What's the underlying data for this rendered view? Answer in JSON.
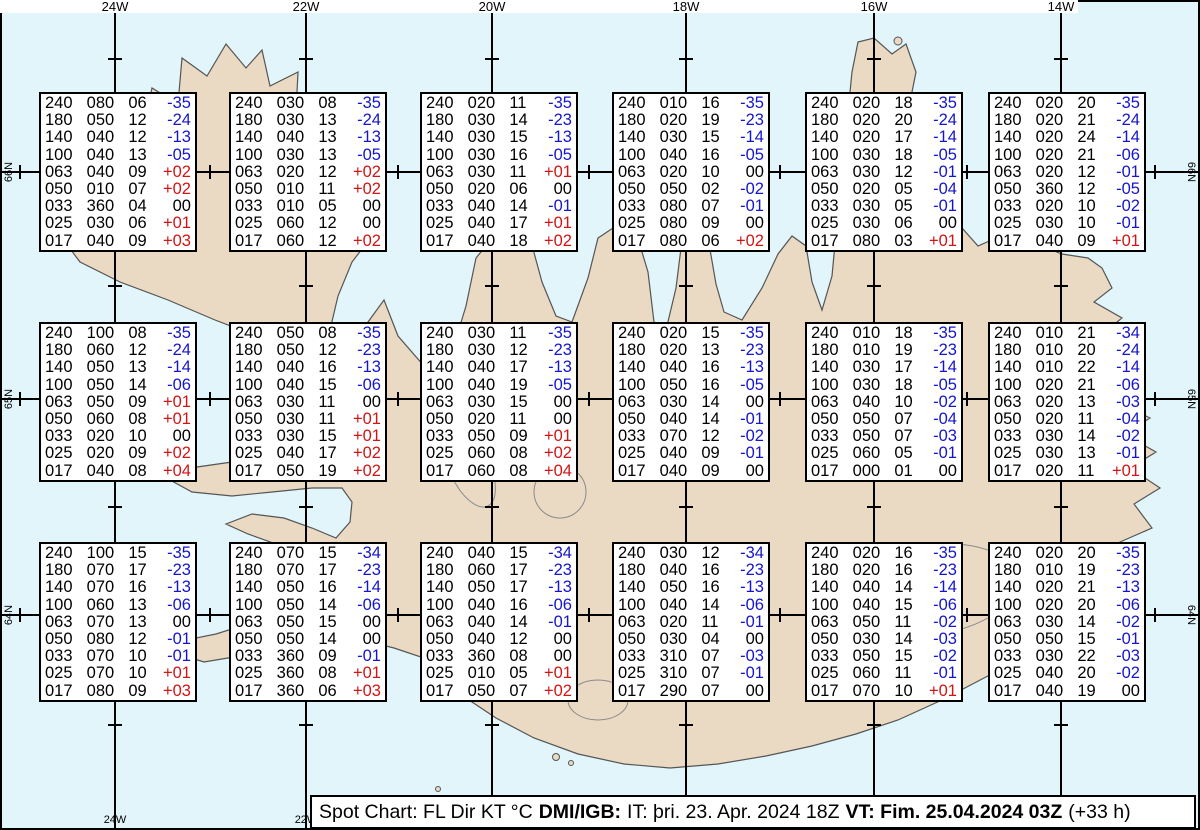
{
  "axis": {
    "lon_labels": [
      "24W",
      "22W",
      "20W",
      "18W",
      "16W",
      "14W"
    ],
    "lat_labels": [
      "66N",
      "65N",
      "64N"
    ]
  },
  "footer": {
    "prefix": "Spot Chart: FL Dir KT °C",
    "org": "DMI/IGB:",
    "run": "IT: þri. 23. Apr. 2024 18Z",
    "valid": "VT: Fim. 25.04.2024 03Z",
    "offset": "(+33 h)"
  },
  "colors": {
    "ocean": "#e1f5fb",
    "land": "#ead9c3",
    "coast": "#555555",
    "glacier_line": "#8a8a8a",
    "grid": "#000000",
    "temp_neg": "#1515cd",
    "temp_pos": "#d01515",
    "temp_zero": "#000000"
  },
  "layout": {
    "meridians_x": [
      115,
      306,
      492,
      686,
      874,
      1061
    ],
    "parallels_y": [
      172,
      399,
      615
    ],
    "lat_tick_x": [
      20,
      210,
      398,
      589,
      780,
      967,
      1155
    ],
    "lon_tick_y": [
      59,
      286,
      507,
      725
    ],
    "box_left": [
      39,
      229,
      420,
      612,
      805,
      988
    ],
    "box_top": [
      92,
      322,
      542
    ]
  },
  "stations": [
    {
      "col": 0,
      "row": 0,
      "levels": [
        [
          "240",
          "080",
          "06",
          "-35"
        ],
        [
          "180",
          "050",
          "12",
          "-24"
        ],
        [
          "140",
          "040",
          "12",
          "-13"
        ],
        [
          "100",
          "040",
          "13",
          "-05"
        ],
        [
          "063",
          "040",
          "09",
          "+02"
        ],
        [
          "050",
          "010",
          "07",
          "+02"
        ],
        [
          "033",
          "360",
          "04",
          "00"
        ],
        [
          "025",
          "030",
          "06",
          "+01"
        ],
        [
          "017",
          "040",
          "09",
          "+03"
        ]
      ]
    },
    {
      "col": 1,
      "row": 0,
      "levels": [
        [
          "240",
          "030",
          "08",
          "-35"
        ],
        [
          "180",
          "030",
          "13",
          "-24"
        ],
        [
          "140",
          "040",
          "13",
          "-13"
        ],
        [
          "100",
          "030",
          "13",
          "-05"
        ],
        [
          "063",
          "020",
          "12",
          "+02"
        ],
        [
          "050",
          "010",
          "11",
          "+02"
        ],
        [
          "033",
          "010",
          "05",
          "00"
        ],
        [
          "025",
          "060",
          "12",
          "00"
        ],
        [
          "017",
          "060",
          "12",
          "+02"
        ]
      ]
    },
    {
      "col": 2,
      "row": 0,
      "levels": [
        [
          "240",
          "020",
          "11",
          "-35"
        ],
        [
          "180",
          "030",
          "14",
          "-23"
        ],
        [
          "140",
          "030",
          "15",
          "-13"
        ],
        [
          "100",
          "030",
          "16",
          "-05"
        ],
        [
          "063",
          "030",
          "11",
          "+01"
        ],
        [
          "050",
          "020",
          "06",
          "00"
        ],
        [
          "033",
          "040",
          "14",
          "-01"
        ],
        [
          "025",
          "040",
          "17",
          "+01"
        ],
        [
          "017",
          "040",
          "18",
          "+02"
        ]
      ]
    },
    {
      "col": 3,
      "row": 0,
      "levels": [
        [
          "240",
          "010",
          "16",
          "-35"
        ],
        [
          "180",
          "020",
          "19",
          "-23"
        ],
        [
          "140",
          "030",
          "15",
          "-14"
        ],
        [
          "100",
          "040",
          "16",
          "-05"
        ],
        [
          "063",
          "020",
          "10",
          "00"
        ],
        [
          "050",
          "050",
          "02",
          "-02"
        ],
        [
          "033",
          "080",
          "07",
          "-01"
        ],
        [
          "025",
          "080",
          "09",
          "00"
        ],
        [
          "017",
          "080",
          "06",
          "+02"
        ]
      ]
    },
    {
      "col": 4,
      "row": 0,
      "levels": [
        [
          "240",
          "020",
          "18",
          "-35"
        ],
        [
          "180",
          "020",
          "20",
          "-24"
        ],
        [
          "140",
          "020",
          "17",
          "-14"
        ],
        [
          "100",
          "030",
          "18",
          "-05"
        ],
        [
          "063",
          "030",
          "12",
          "-01"
        ],
        [
          "050",
          "020",
          "05",
          "-04"
        ],
        [
          "033",
          "030",
          "05",
          "-01"
        ],
        [
          "025",
          "030",
          "06",
          "00"
        ],
        [
          "017",
          "080",
          "03",
          "+01"
        ]
      ]
    },
    {
      "col": 5,
      "row": 0,
      "levels": [
        [
          "240",
          "020",
          "20",
          "-35"
        ],
        [
          "180",
          "020",
          "21",
          "-24"
        ],
        [
          "140",
          "020",
          "24",
          "-14"
        ],
        [
          "100",
          "020",
          "21",
          "-06"
        ],
        [
          "063",
          "020",
          "12",
          "-01"
        ],
        [
          "050",
          "360",
          "12",
          "-05"
        ],
        [
          "033",
          "020",
          "10",
          "-02"
        ],
        [
          "025",
          "030",
          "10",
          "-01"
        ],
        [
          "017",
          "040",
          "09",
          "+01"
        ]
      ]
    },
    {
      "col": 0,
      "row": 1,
      "levels": [
        [
          "240",
          "100",
          "08",
          "-35"
        ],
        [
          "180",
          "060",
          "12",
          "-24"
        ],
        [
          "140",
          "050",
          "13",
          "-14"
        ],
        [
          "100",
          "050",
          "14",
          "-06"
        ],
        [
          "063",
          "050",
          "09",
          "+01"
        ],
        [
          "050",
          "060",
          "08",
          "+01"
        ],
        [
          "033",
          "020",
          "10",
          "00"
        ],
        [
          "025",
          "020",
          "09",
          "+02"
        ],
        [
          "017",
          "040",
          "08",
          "+04"
        ]
      ]
    },
    {
      "col": 1,
      "row": 1,
      "levels": [
        [
          "240",
          "050",
          "08",
          "-35"
        ],
        [
          "180",
          "050",
          "12",
          "-23"
        ],
        [
          "140",
          "040",
          "16",
          "-13"
        ],
        [
          "100",
          "040",
          "15",
          "-06"
        ],
        [
          "063",
          "030",
          "11",
          "00"
        ],
        [
          "050",
          "030",
          "11",
          "+01"
        ],
        [
          "033",
          "030",
          "15",
          "+01"
        ],
        [
          "025",
          "040",
          "17",
          "+02"
        ],
        [
          "017",
          "050",
          "19",
          "+02"
        ]
      ]
    },
    {
      "col": 2,
      "row": 1,
      "levels": [
        [
          "240",
          "030",
          "11",
          "-35"
        ],
        [
          "180",
          "030",
          "12",
          "-23"
        ],
        [
          "140",
          "040",
          "17",
          "-13"
        ],
        [
          "100",
          "040",
          "19",
          "-05"
        ],
        [
          "063",
          "030",
          "15",
          "00"
        ],
        [
          "050",
          "020",
          "11",
          "00"
        ],
        [
          "033",
          "050",
          "09",
          "+01"
        ],
        [
          "025",
          "060",
          "08",
          "+02"
        ],
        [
          "017",
          "060",
          "08",
          "+04"
        ]
      ]
    },
    {
      "col": 3,
      "row": 1,
      "levels": [
        [
          "240",
          "020",
          "15",
          "-35"
        ],
        [
          "180",
          "020",
          "13",
          "-23"
        ],
        [
          "140",
          "040",
          "16",
          "-13"
        ],
        [
          "100",
          "050",
          "16",
          "-05"
        ],
        [
          "063",
          "030",
          "14",
          "00"
        ],
        [
          "050",
          "040",
          "14",
          "-01"
        ],
        [
          "033",
          "070",
          "12",
          "-02"
        ],
        [
          "025",
          "040",
          "09",
          "-01"
        ],
        [
          "017",
          "040",
          "09",
          "00"
        ]
      ]
    },
    {
      "col": 4,
      "row": 1,
      "levels": [
        [
          "240",
          "010",
          "18",
          "-35"
        ],
        [
          "180",
          "010",
          "19",
          "-23"
        ],
        [
          "140",
          "030",
          "17",
          "-14"
        ],
        [
          "100",
          "030",
          "18",
          "-05"
        ],
        [
          "063",
          "040",
          "10",
          "-02"
        ],
        [
          "050",
          "050",
          "07",
          "-04"
        ],
        [
          "033",
          "050",
          "07",
          "-03"
        ],
        [
          "025",
          "060",
          "05",
          "-01"
        ],
        [
          "017",
          "000",
          "01",
          "00"
        ]
      ]
    },
    {
      "col": 5,
      "row": 1,
      "levels": [
        [
          "240",
          "010",
          "21",
          "-34"
        ],
        [
          "180",
          "010",
          "20",
          "-24"
        ],
        [
          "140",
          "010",
          "22",
          "-14"
        ],
        [
          "100",
          "020",
          "21",
          "-06"
        ],
        [
          "063",
          "020",
          "13",
          "-03"
        ],
        [
          "050",
          "020",
          "11",
          "-04"
        ],
        [
          "033",
          "030",
          "14",
          "-02"
        ],
        [
          "025",
          "030",
          "13",
          "-01"
        ],
        [
          "017",
          "020",
          "11",
          "+01"
        ]
      ]
    },
    {
      "col": 0,
      "row": 2,
      "levels": [
        [
          "240",
          "100",
          "15",
          "-35"
        ],
        [
          "180",
          "070",
          "17",
          "-23"
        ],
        [
          "140",
          "070",
          "16",
          "-13"
        ],
        [
          "100",
          "060",
          "13",
          "-06"
        ],
        [
          "063",
          "070",
          "13",
          "00"
        ],
        [
          "050",
          "080",
          "12",
          "-01"
        ],
        [
          "033",
          "070",
          "10",
          "-01"
        ],
        [
          "025",
          "070",
          "10",
          "+01"
        ],
        [
          "017",
          "080",
          "09",
          "+03"
        ]
      ]
    },
    {
      "col": 1,
      "row": 2,
      "levels": [
        [
          "240",
          "070",
          "15",
          "-34"
        ],
        [
          "180",
          "070",
          "17",
          "-23"
        ],
        [
          "140",
          "050",
          "16",
          "-14"
        ],
        [
          "100",
          "050",
          "14",
          "-06"
        ],
        [
          "063",
          "050",
          "15",
          "00"
        ],
        [
          "050",
          "050",
          "14",
          "00"
        ],
        [
          "033",
          "360",
          "09",
          "-01"
        ],
        [
          "025",
          "360",
          "08",
          "+01"
        ],
        [
          "017",
          "360",
          "06",
          "+03"
        ]
      ]
    },
    {
      "col": 2,
      "row": 2,
      "levels": [
        [
          "240",
          "040",
          "15",
          "-34"
        ],
        [
          "180",
          "060",
          "17",
          "-23"
        ],
        [
          "140",
          "050",
          "17",
          "-13"
        ],
        [
          "100",
          "040",
          "16",
          "-06"
        ],
        [
          "063",
          "040",
          "14",
          "-01"
        ],
        [
          "050",
          "040",
          "12",
          "00"
        ],
        [
          "033",
          "360",
          "08",
          "00"
        ],
        [
          "025",
          "010",
          "05",
          "+01"
        ],
        [
          "017",
          "050",
          "07",
          "+02"
        ]
      ]
    },
    {
      "col": 3,
      "row": 2,
      "levels": [
        [
          "240",
          "030",
          "12",
          "-34"
        ],
        [
          "180",
          "040",
          "16",
          "-23"
        ],
        [
          "140",
          "050",
          "16",
          "-13"
        ],
        [
          "100",
          "040",
          "14",
          "-06"
        ],
        [
          "063",
          "020",
          "11",
          "-01"
        ],
        [
          "050",
          "030",
          "04",
          "00"
        ],
        [
          "033",
          "310",
          "07",
          "-03"
        ],
        [
          "025",
          "310",
          "07",
          "-01"
        ],
        [
          "017",
          "290",
          "07",
          "00"
        ]
      ]
    },
    {
      "col": 4,
      "row": 2,
      "levels": [
        [
          "240",
          "020",
          "16",
          "-35"
        ],
        [
          "180",
          "020",
          "16",
          "-23"
        ],
        [
          "140",
          "040",
          "14",
          "-14"
        ],
        [
          "100",
          "040",
          "15",
          "-06"
        ],
        [
          "063",
          "050",
          "11",
          "-02"
        ],
        [
          "050",
          "030",
          "14",
          "-03"
        ],
        [
          "033",
          "050",
          "15",
          "-02"
        ],
        [
          "025",
          "060",
          "11",
          "-01"
        ],
        [
          "017",
          "070",
          "10",
          "+01"
        ]
      ]
    },
    {
      "col": 5,
      "row": 2,
      "levels": [
        [
          "240",
          "020",
          "20",
          "-35"
        ],
        [
          "180",
          "010",
          "19",
          "-23"
        ],
        [
          "140",
          "020",
          "21",
          "-13"
        ],
        [
          "100",
          "020",
          "20",
          "-06"
        ],
        [
          "063",
          "030",
          "14",
          "-02"
        ],
        [
          "050",
          "050",
          "15",
          "-01"
        ],
        [
          "033",
          "030",
          "22",
          "-03"
        ],
        [
          "025",
          "040",
          "20",
          "-02"
        ],
        [
          "017",
          "040",
          "19",
          "00"
        ]
      ]
    }
  ]
}
